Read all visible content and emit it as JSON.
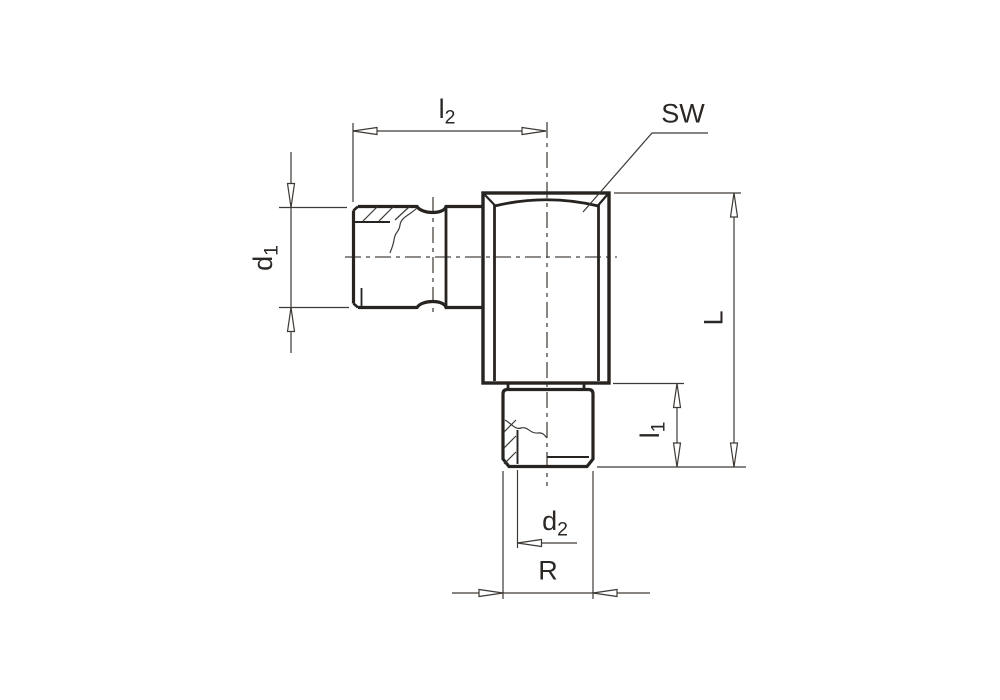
{
  "drawing": {
    "type": "technical-drawing",
    "subject": "90-degree elbow threaded fitting, side view with partial thread sections",
    "background_color": "#ffffff",
    "outline_color": "#2b2724",
    "thin_line_color": "#3d3935",
    "labels": {
      "l2": {
        "base": "l",
        "sub": "2"
      },
      "sw": {
        "text": "SW"
      },
      "d1": {
        "base": "d",
        "sub": "1"
      },
      "L": {
        "text": "L"
      },
      "l1": {
        "base": "l",
        "sub": "1"
      },
      "d2": {
        "base": "d",
        "sub": "2"
      },
      "R": {
        "text": "R"
      }
    }
  }
}
